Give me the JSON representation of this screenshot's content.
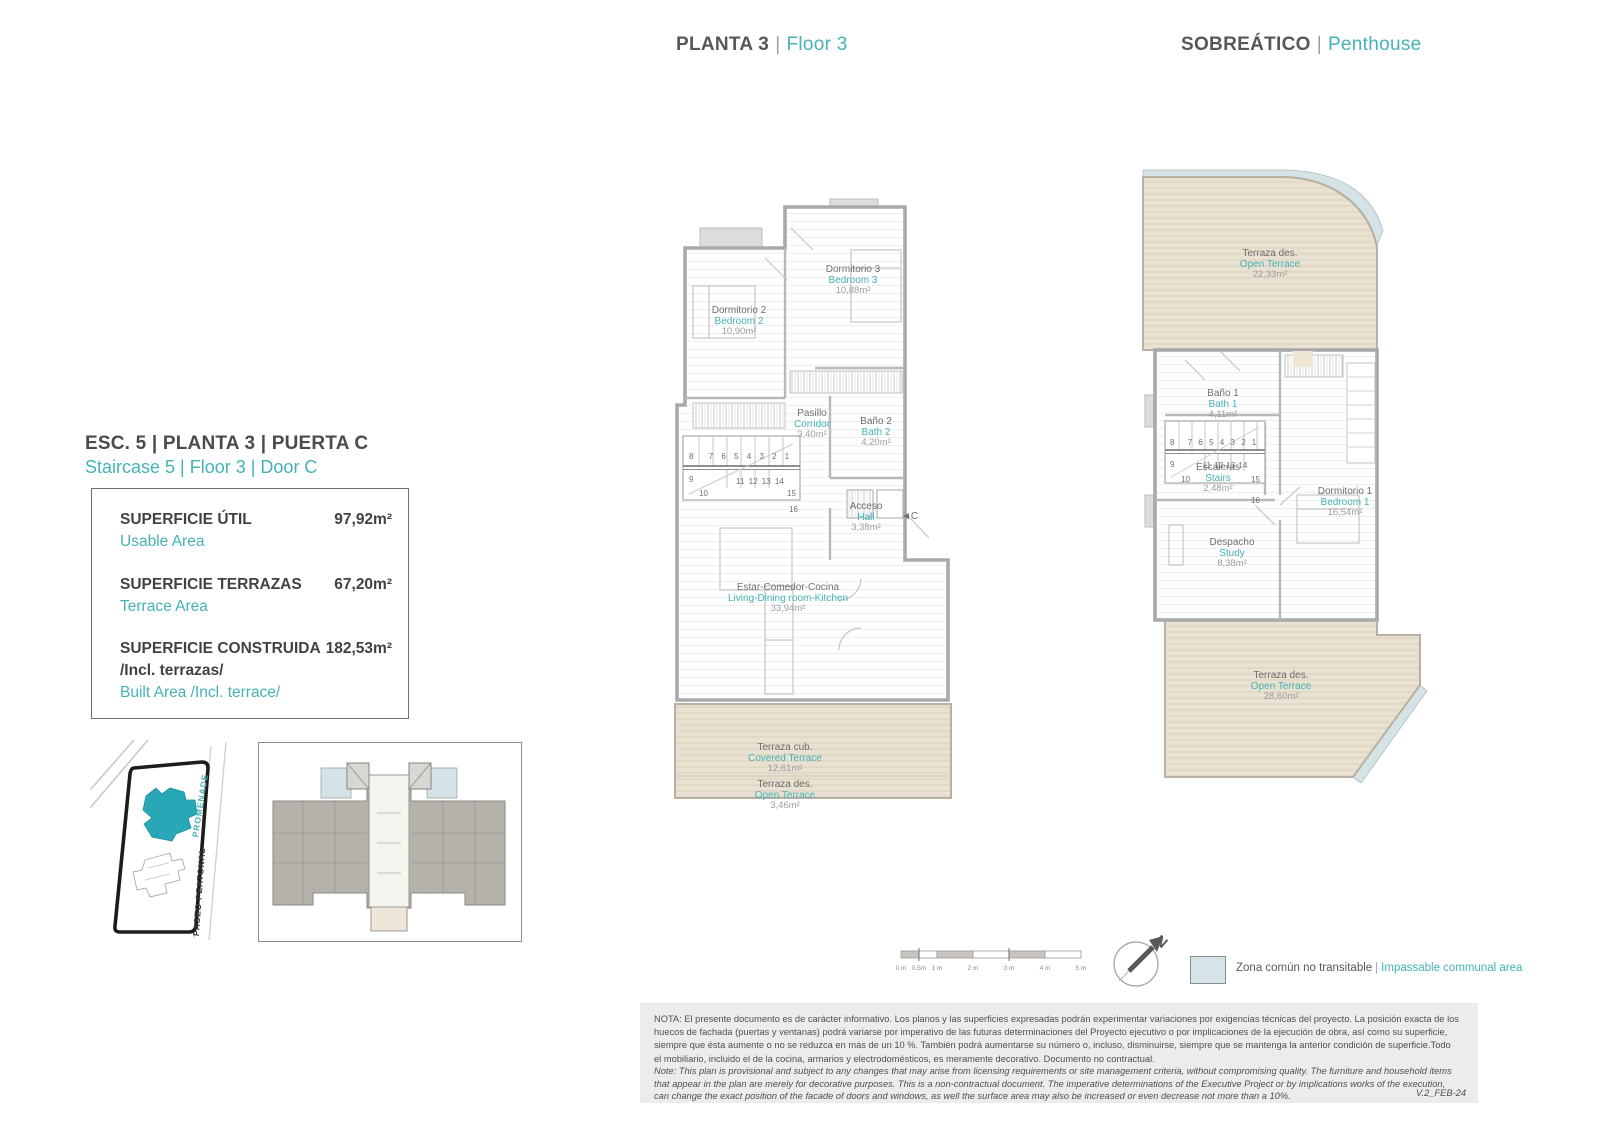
{
  "colors": {
    "teal": "#45b2b6",
    "dark_text": "#58595b",
    "terrace_fill": "#e9e1d1",
    "communal_fill": "#d7e4e7",
    "note_bg": "#ececec"
  },
  "header_left": {
    "es": "PLANTA 3",
    "divider": "|",
    "en": "Floor 3"
  },
  "header_right": {
    "es": "SOBREÁTICO",
    "divider": "|",
    "en": "Penthouse"
  },
  "unit": {
    "title_es": "ESC. 5 | PLANTA 3 | PUERTA C",
    "title_en": "Staircase 5 | Floor 3 | Door C"
  },
  "areas": {
    "rows": [
      {
        "es": "SUPERFICIE ÚTIL",
        "es2": "",
        "en": "Usable Area",
        "value": "97,92m²"
      },
      {
        "es": "SUPERFICIE TERRAZAS",
        "es2": "",
        "en": "Terrace Area",
        "value": "67,20m²"
      },
      {
        "es": "SUPERFICIE CONSTRUIDA",
        "es2": "/Incl. terrazas/",
        "en": "Built Area /Incl. terrace/",
        "value": "182,53m²"
      }
    ]
  },
  "site_map": {
    "street_promenade": "PROMENADE",
    "street_paseo": "PASEO PEATONAL"
  },
  "plan_floor3": {
    "rooms": {
      "bedroom2": {
        "es": "Dormitorio 2",
        "en": "Bedroom 2",
        "area": "10,90m²"
      },
      "bedroom3": {
        "es": "Dormitorio 3",
        "en": "Bedroom 3",
        "area": "10,88m²"
      },
      "corridor": {
        "es": "Pasillo",
        "en": "Corridor",
        "area": "3,40m²"
      },
      "bath2": {
        "es": "Baño 2",
        "en": "Bath 2",
        "area": "4,20m²"
      },
      "hall": {
        "es": "Acceso",
        "en": "Hall",
        "area": "3,38m²"
      },
      "living": {
        "es": "Estar-Comedor-Cocina",
        "en": "Living-Dining room-Kitchen",
        "area": "33,94m²"
      },
      "covered_terrace": {
        "es": "Terraza cub.",
        "en": "Covered Terrace",
        "area": "12,61m²"
      },
      "open_terrace": {
        "es": "Terraza des.",
        "en": "Open Terrace",
        "area": "3,46m²"
      }
    },
    "door_label": "◄C",
    "stairs": {
      "n8": "8",
      "top_row": "7 6 5 4 3 2 1",
      "n9": "9",
      "mid_row": "11 12 13 14",
      "n10": "10",
      "n15": "15",
      "n16": "16"
    }
  },
  "plan_penthouse": {
    "rooms": {
      "top_terrace": {
        "es": "Terraza des.",
        "en": "Open Terrace",
        "area": "22,33m²"
      },
      "bath1": {
        "es": "Baño 1",
        "en": "Bath 1",
        "area": "4,11m²"
      },
      "stairs": {
        "es": "Escaleras",
        "en": "Stairs",
        "area": "2,48m²"
      },
      "bedroom1": {
        "es": "Dormitorio 1",
        "en": "Bedroom 1",
        "area": "16,54m²"
      },
      "study": {
        "es": "Despacho",
        "en": "Study",
        "area": "8,38m²"
      },
      "bottom_terrace": {
        "es": "Terraza des.",
        "en": "Open Terrace",
        "area": "28,60m²"
      }
    },
    "stairs_numbers": {
      "n8": "8",
      "top_row": "7 6 5 4 3 2 1",
      "n9": "9",
      "mid_row": "11 12 13 14",
      "n10": "10",
      "n15": "15",
      "n16": "16"
    }
  },
  "scale_bar": {
    "labels": [
      "0 m",
      "0,5m",
      "1 m",
      "2 m",
      "3 m",
      "4 m",
      "5 m"
    ]
  },
  "compass": {
    "label": "N"
  },
  "legend": {
    "es": "Zona común no transitable",
    "divider": "|",
    "en": "Impassable communal area"
  },
  "notes": {
    "es": "NOTA:  El presente documento es de carácter informativo. Los planos y las superficies expresadas podrán experimentar variaciones por exigencias técnicas del proyecto. La posición exacta de los huecos de fachada (puertas y ventanas) podrá variarse por imperativo de las futuras determinaciones del Proyecto ejecutivo o por implicaciones de la ejecución de obra, así como su superficie, siempre que ésta aumente o no se reduzca en más de un 10 %. También podrá aumentarse su número o, incluso, disminuirse, siempre que se mantenga la anterior condición de superficie.Todo el mobiliario, incluido el de la cocina, armarios y electrodomésticos, es meramente decorativo. Documento no contractual.",
    "en": "Note: This plan is provisional and subject to any changes that may arise from licensing requirements or site management criteria, without compromising quality. The furniture and household items that appear in the plan are merely for decorative purposes. This is a non-contractual document. The imperative determinations of the Executive Project or by implications works of the execution, can change the exact position of the facade of doors and windows, as well the surface area may also be increased or even decrease not more than a 10%.",
    "version": "V.2_FEB-24"
  }
}
